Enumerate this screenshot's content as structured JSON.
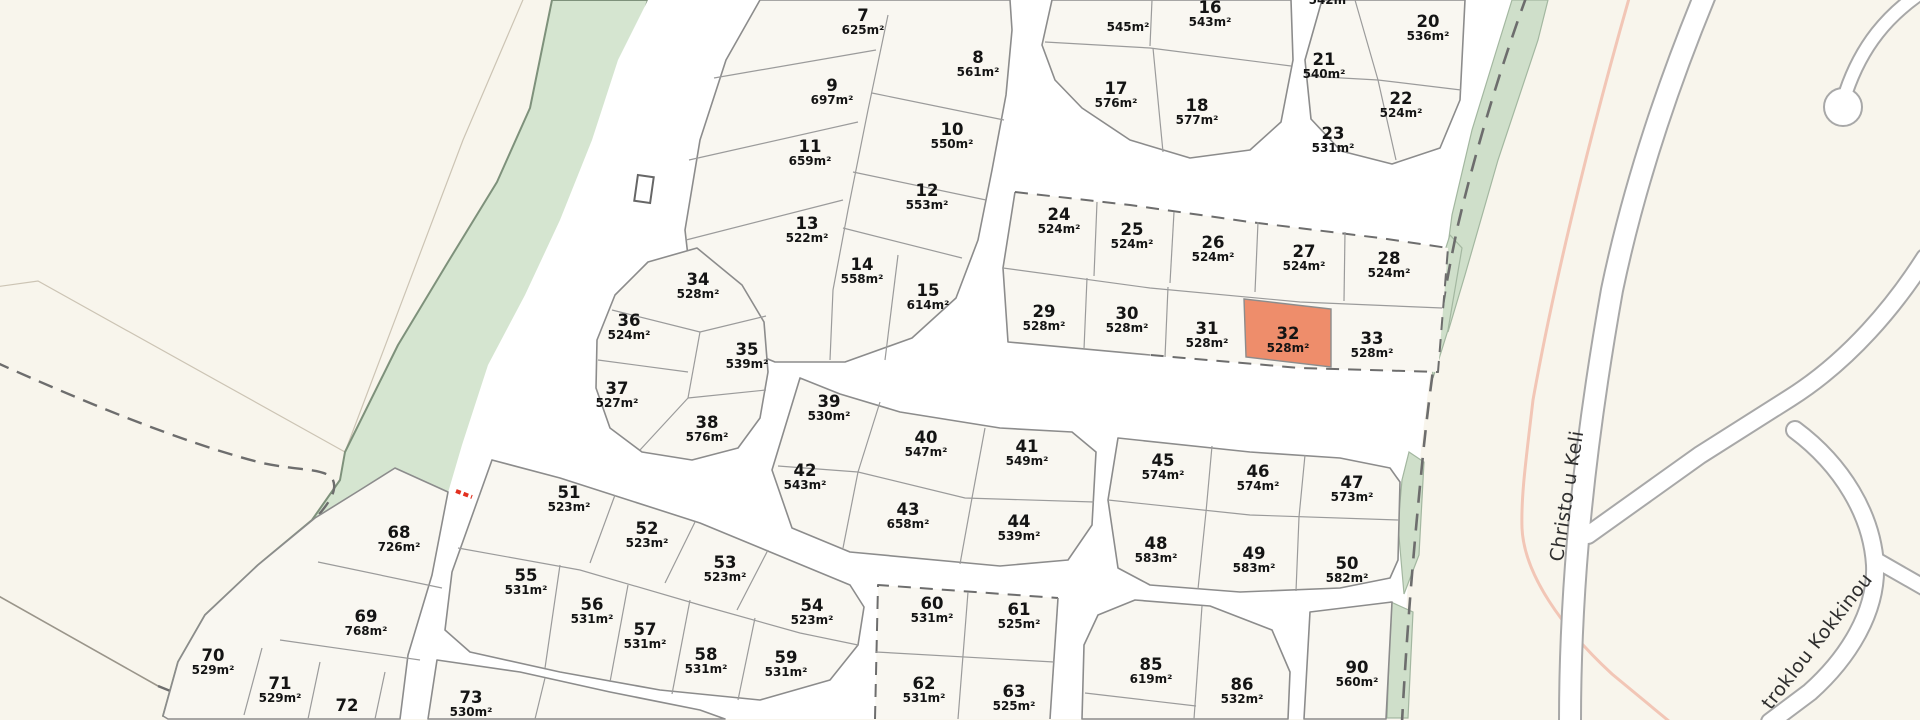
{
  "map": {
    "selected_plot": {
      "num": "32",
      "area": "528m²"
    },
    "plots": [
      {
        "num": "",
        "area": "545m²",
        "x": 1128,
        "y": 19
      },
      {
        "num": "",
        "area": "542m²",
        "x": 1330,
        "y": -8
      },
      {
        "num": "7",
        "area": "625m²",
        "x": 863,
        "y": 22
      },
      {
        "num": "8",
        "area": "561m²",
        "x": 978,
        "y": 64
      },
      {
        "num": "9",
        "area": "697m²",
        "x": 832,
        "y": 92
      },
      {
        "num": "10",
        "area": "550m²",
        "x": 952,
        "y": 136
      },
      {
        "num": "11",
        "area": "659m²",
        "x": 810,
        "y": 153
      },
      {
        "num": "12",
        "area": "553m²",
        "x": 927,
        "y": 197
      },
      {
        "num": "13",
        "area": "522m²",
        "x": 807,
        "y": 230
      },
      {
        "num": "14",
        "area": "558m²",
        "x": 862,
        "y": 271
      },
      {
        "num": "15",
        "area": "614m²",
        "x": 928,
        "y": 297
      },
      {
        "num": "16",
        "area": "543m²",
        "x": 1210,
        "y": 14
      },
      {
        "num": "17",
        "area": "576m²",
        "x": 1116,
        "y": 95
      },
      {
        "num": "18",
        "area": "577m²",
        "x": 1197,
        "y": 112
      },
      {
        "num": "20",
        "area": "536m²",
        "x": 1428,
        "y": 28
      },
      {
        "num": "21",
        "area": "540m²",
        "x": 1324,
        "y": 66
      },
      {
        "num": "22",
        "area": "524m²",
        "x": 1401,
        "y": 105
      },
      {
        "num": "23",
        "area": "531m²",
        "x": 1333,
        "y": 140
      },
      {
        "num": "24",
        "area": "524m²",
        "x": 1059,
        "y": 221
      },
      {
        "num": "25",
        "area": "524m²",
        "x": 1132,
        "y": 236
      },
      {
        "num": "26",
        "area": "524m²",
        "x": 1213,
        "y": 249
      },
      {
        "num": "27",
        "area": "524m²",
        "x": 1304,
        "y": 258
      },
      {
        "num": "28",
        "area": "524m²",
        "x": 1389,
        "y": 265
      },
      {
        "num": "29",
        "area": "528m²",
        "x": 1044,
        "y": 318
      },
      {
        "num": "30",
        "area": "528m²",
        "x": 1127,
        "y": 320
      },
      {
        "num": "31",
        "area": "528m²",
        "x": 1207,
        "y": 335
      },
      {
        "num": "32",
        "area": "528m²",
        "x": 1288,
        "y": 340
      },
      {
        "num": "33",
        "area": "528m²",
        "x": 1372,
        "y": 345
      },
      {
        "num": "34",
        "area": "528m²",
        "x": 698,
        "y": 286
      },
      {
        "num": "35",
        "area": "539m²",
        "x": 747,
        "y": 356
      },
      {
        "num": "36",
        "area": "524m²",
        "x": 629,
        "y": 327
      },
      {
        "num": "37",
        "area": "527m²",
        "x": 617,
        "y": 395
      },
      {
        "num": "38",
        "area": "576m²",
        "x": 707,
        "y": 429
      },
      {
        "num": "39",
        "area": "530m²",
        "x": 829,
        "y": 408
      },
      {
        "num": "40",
        "area": "547m²",
        "x": 926,
        "y": 444
      },
      {
        "num": "41",
        "area": "549m²",
        "x": 1027,
        "y": 453
      },
      {
        "num": "42",
        "area": "543m²",
        "x": 805,
        "y": 477
      },
      {
        "num": "43",
        "area": "658m²",
        "x": 908,
        "y": 516
      },
      {
        "num": "44",
        "area": "539m²",
        "x": 1019,
        "y": 528
      },
      {
        "num": "45",
        "area": "574m²",
        "x": 1163,
        "y": 467
      },
      {
        "num": "46",
        "area": "574m²",
        "x": 1258,
        "y": 478
      },
      {
        "num": "47",
        "area": "573m²",
        "x": 1352,
        "y": 489
      },
      {
        "num": "48",
        "area": "583m²",
        "x": 1156,
        "y": 550
      },
      {
        "num": "49",
        "area": "583m²",
        "x": 1254,
        "y": 560
      },
      {
        "num": "50",
        "area": "582m²",
        "x": 1347,
        "y": 570
      },
      {
        "num": "51",
        "area": "523m²",
        "x": 569,
        "y": 499
      },
      {
        "num": "52",
        "area": "523m²",
        "x": 647,
        "y": 535
      },
      {
        "num": "53",
        "area": "523m²",
        "x": 725,
        "y": 569
      },
      {
        "num": "54",
        "area": "523m²",
        "x": 812,
        "y": 612
      },
      {
        "num": "55",
        "area": "531m²",
        "x": 526,
        "y": 582
      },
      {
        "num": "56",
        "area": "531m²",
        "x": 592,
        "y": 611
      },
      {
        "num": "57",
        "area": "531m²",
        "x": 645,
        "y": 636
      },
      {
        "num": "58",
        "area": "531m²",
        "x": 706,
        "y": 661
      },
      {
        "num": "59",
        "area": "531m²",
        "x": 786,
        "y": 664
      },
      {
        "num": "60",
        "area": "531m²",
        "x": 932,
        "y": 610
      },
      {
        "num": "61",
        "area": "525m²",
        "x": 1019,
        "y": 616
      },
      {
        "num": "62",
        "area": "531m²",
        "x": 924,
        "y": 690
      },
      {
        "num": "63",
        "area": "525m²",
        "x": 1014,
        "y": 698
      },
      {
        "num": "68",
        "area": "726m²",
        "x": 399,
        "y": 539
      },
      {
        "num": "69",
        "area": "768m²",
        "x": 366,
        "y": 623
      },
      {
        "num": "70",
        "area": "529m²",
        "x": 213,
        "y": 662
      },
      {
        "num": "71",
        "area": "529m²",
        "x": 280,
        "y": 690
      },
      {
        "num": "72",
        "area": "",
        "x": 347,
        "y": 712
      },
      {
        "num": "73",
        "area": "530m²",
        "x": 471,
        "y": 704
      },
      {
        "num": "85",
        "area": "619m²",
        "x": 1151,
        "y": 671
      },
      {
        "num": "86",
        "area": "532m²",
        "x": 1242,
        "y": 691
      },
      {
        "num": "90",
        "area": "560m²",
        "x": 1357,
        "y": 674
      }
    ],
    "streets": [
      {
        "name": "Christo u Keli",
        "x": 1573,
        "y": 497,
        "rotate": -81
      },
      {
        "name": "troklou Kokkinou",
        "x": 1822,
        "y": 645,
        "rotate": -52
      }
    ]
  },
  "colors": {
    "background": "#f8f5ec",
    "road": "#ffffff",
    "road_casing": "#a8a8a8",
    "block_fill": "#f9f7f1",
    "block_stroke": "#8c8c8c",
    "green": "#d5e5d0",
    "green_border": "#7e917b",
    "highlight": "#ee8d6b",
    "boundary_dash": "#6d6d6d",
    "pink_path": "#f2c6b6",
    "red_marker": "#e2301f",
    "label_text": "#141414",
    "street_text": "#2e2e2e"
  }
}
